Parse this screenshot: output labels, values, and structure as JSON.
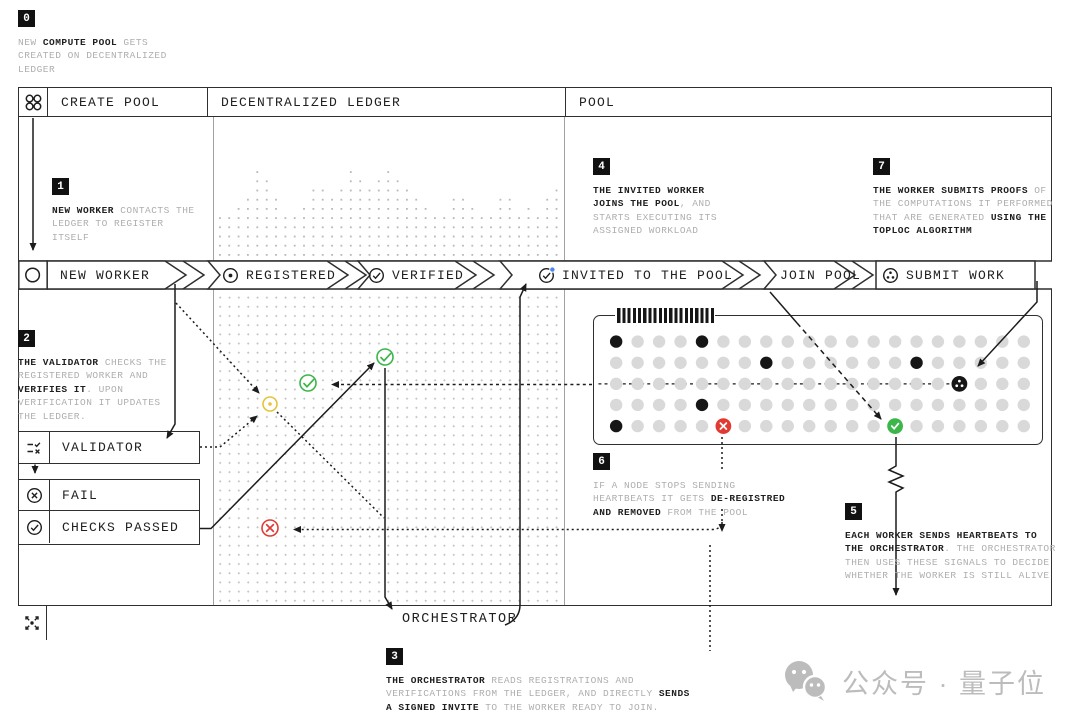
{
  "colors": {
    "ink": "#1f1f1f",
    "muted": "#aeaeae",
    "frame": "#2f2f2f",
    "inner_border": "#a2a2a2",
    "grid_dot": "#c4c4c4",
    "pool_dot": "#d9d9d9",
    "ok": "#3cb54a",
    "fail": "#e23a33",
    "pending": "#e5c43c",
    "notif": "#4c86f2",
    "badge_bg": "#111111",
    "watermark": "#bcbcbc"
  },
  "header": {
    "columns": [
      "CREATE POOL",
      "DECENTRALIZED LEDGER",
      "POOL"
    ]
  },
  "flow": [
    {
      "label": "NEW WORKER",
      "icon": "circle-icon"
    },
    {
      "label": "REGISTERED",
      "icon": "dot-circle-icon"
    },
    {
      "label": "VERIFIED",
      "icon": "check-circle-icon"
    },
    {
      "label": "INVITED TO THE POOL",
      "icon": "check-circle-notification-icon"
    },
    {
      "label": "JOIN POOL",
      "icon": null
    },
    {
      "label": "SUBMIT WORK",
      "icon": "proof-circle-icon"
    }
  ],
  "boxes": {
    "validator": "VALIDATOR",
    "fail": "FAIL",
    "checks_passed": "CHECKS PASSED"
  },
  "labels": {
    "orchestrator": "ORCHESTRATOR"
  },
  "steps": [
    {
      "n": "0",
      "lines": [
        [
          {
            "t": "NEW "
          },
          {
            "t": "COMPUTE POOL",
            "b": true
          },
          {
            "t": " GETS"
          }
        ],
        [
          {
            "t": "CREATED ON DECENTRALIZED"
          }
        ],
        [
          {
            "t": "LEDGER"
          }
        ]
      ]
    },
    {
      "n": "1",
      "lines": [
        [
          {
            "t": "NEW WORKER",
            "b": true
          },
          {
            "t": " CONTACTS THE"
          }
        ],
        [
          {
            "t": "LEDGER TO REGISTER"
          }
        ],
        [
          {
            "t": "ITSELF"
          }
        ]
      ]
    },
    {
      "n": "2",
      "lines": [
        [
          {
            "t": "THE VALIDATOR",
            "b": true
          },
          {
            "t": " CHECKS THE"
          }
        ],
        [
          {
            "t": "REGISTERED WORKER AND"
          }
        ],
        [
          {
            "t": "VERIFIES IT",
            "b": true
          },
          {
            "t": ". UPON"
          }
        ],
        [
          {
            "t": "VERIFICATION IT UPDATES"
          }
        ],
        [
          {
            "t": "THE LEDGER."
          }
        ]
      ]
    },
    {
      "n": "3",
      "lines": [
        [
          {
            "t": "THE ORCHESTRATOR",
            "b": true
          },
          {
            "t": " READS REGISTRATIONS AND"
          }
        ],
        [
          {
            "t": "VERIFICATIONS FROM THE LEDGER, AND DIRECTLY "
          },
          {
            "t": "SENDS",
            "b": true
          }
        ],
        [
          {
            "t": "A SIGNED INVITE",
            "b": true
          },
          {
            "t": " TO THE WORKER READY TO JOIN."
          }
        ]
      ]
    },
    {
      "n": "4",
      "lines": [
        [
          {
            "t": "THE INVITED WORKER",
            "b": true
          }
        ],
        [
          {
            "t": "JOINS THE POOL",
            "b": true
          },
          {
            "t": ", AND"
          }
        ],
        [
          {
            "t": "STARTS EXECUTING ITS"
          }
        ],
        [
          {
            "t": "ASSIGNED WORKLOAD"
          }
        ]
      ]
    },
    {
      "n": "5",
      "lines": [
        [
          {
            "t": "EACH WORKER SENDS HEARTBEATS TO",
            "b": true
          }
        ],
        [
          {
            "t": "THE ORCHESTRATOR",
            "b": true
          },
          {
            "t": ". THE ORCHESTRATOR"
          }
        ],
        [
          {
            "t": "THEN USES THESE SIGNALS TO DECIDE"
          }
        ],
        [
          {
            "t": "WHETHER THE WORKER IS STILL ALIVE"
          }
        ]
      ]
    },
    {
      "n": "6",
      "lines": [
        [
          {
            "t": "IF A NODE STOPS SENDING"
          }
        ],
        [
          {
            "t": "HEARTBEATS IT GETS "
          },
          {
            "t": "DE-REGISTRED",
            "b": true
          }
        ],
        [
          {
            "t": "AND REMOVED",
            "b": true
          },
          {
            "t": " FROM THE POOL"
          }
        ]
      ]
    },
    {
      "n": "7",
      "lines": [
        [
          {
            "t": "THE WORKER SUBMITS PROOFS",
            "b": true
          },
          {
            "t": " OF"
          }
        ],
        [
          {
            "t": "THE COMPUTATIONS IT PERFORMED"
          }
        ],
        [
          {
            "t": "THAT ARE GENERATED "
          },
          {
            "t": "USING THE",
            "b": true
          }
        ],
        [
          {
            "t": "TOPLOC ALGORITHM",
            "b": true
          }
        ]
      ]
    }
  ],
  "pool": {
    "cols": 20,
    "rows": 5,
    "black_dots": [
      [
        0,
        0
      ],
      [
        0,
        4
      ],
      [
        1,
        7
      ],
      [
        1,
        14
      ],
      [
        3,
        4
      ],
      [
        4,
        0
      ]
    ],
    "markers": [
      {
        "row": 2,
        "col": 16,
        "type": "proof-black"
      },
      {
        "row": 4,
        "col": 5,
        "type": "removed-red"
      },
      {
        "row": 4,
        "col": 13,
        "type": "alive-green"
      }
    ]
  },
  "ledger_skyline": {
    "heights": [
      5,
      5,
      6,
      7,
      10,
      9,
      7,
      5,
      5,
      6,
      8,
      8,
      7,
      8,
      10,
      9,
      8,
      9,
      10,
      9,
      8,
      7,
      6,
      5,
      5,
      7,
      7,
      6,
      5,
      5,
      7,
      7,
      5,
      6,
      5,
      7,
      8
    ]
  },
  "ledger_markers": [
    {
      "type": "pending-check"
    },
    {
      "type": "verified-check"
    },
    {
      "type": "verified-check"
    },
    {
      "type": "failed-x"
    }
  ],
  "watermark": {
    "text": "公众号 · 量子位",
    "icon": "wechat-icon"
  }
}
